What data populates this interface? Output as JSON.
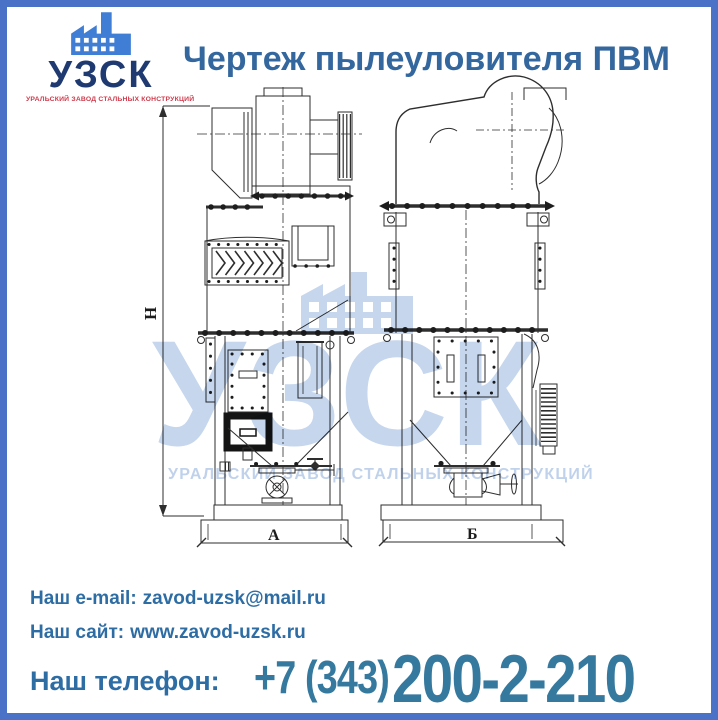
{
  "header": {
    "title": "Чертеж пылеуловителя ПВМ"
  },
  "logo": {
    "name": "УЗСК",
    "subtitle": "УРАЛЬСКИЙ ЗАВОД СТАЛЬНЫХ КОНСТРУКЦИЙ"
  },
  "drawing": {
    "labels": {
      "height": "H",
      "front_width": "А",
      "side_width": "Б"
    }
  },
  "watermark": {
    "name": "УЗСК",
    "subtitle": "УРАЛЬСКИЙ ЗАВОД СТАЛЬНЫХ КОНСТРУКЦИЙ"
  },
  "contacts": {
    "email_label": "Наш e-mail:",
    "email_value": "zavod-uzsk@mail.ru",
    "site_label": "Наш сайт:",
    "site_value": "www.zavod-uzsk.ru",
    "phone_label": "Наш телефон:",
    "phone_area": "+7 (343)",
    "phone_number": "200-2-210"
  },
  "colors": {
    "frame": "#4a73c7",
    "title": "#33679e",
    "logo_name": "#1e3a70",
    "logo_subtitle": "#cf3a4b",
    "logo_icon": "#3f7ed4",
    "contact_text": "#2e6da4",
    "phone": "#35799f",
    "watermark": "#c5d6ed",
    "drawing_line": "#2e2e2e"
  }
}
